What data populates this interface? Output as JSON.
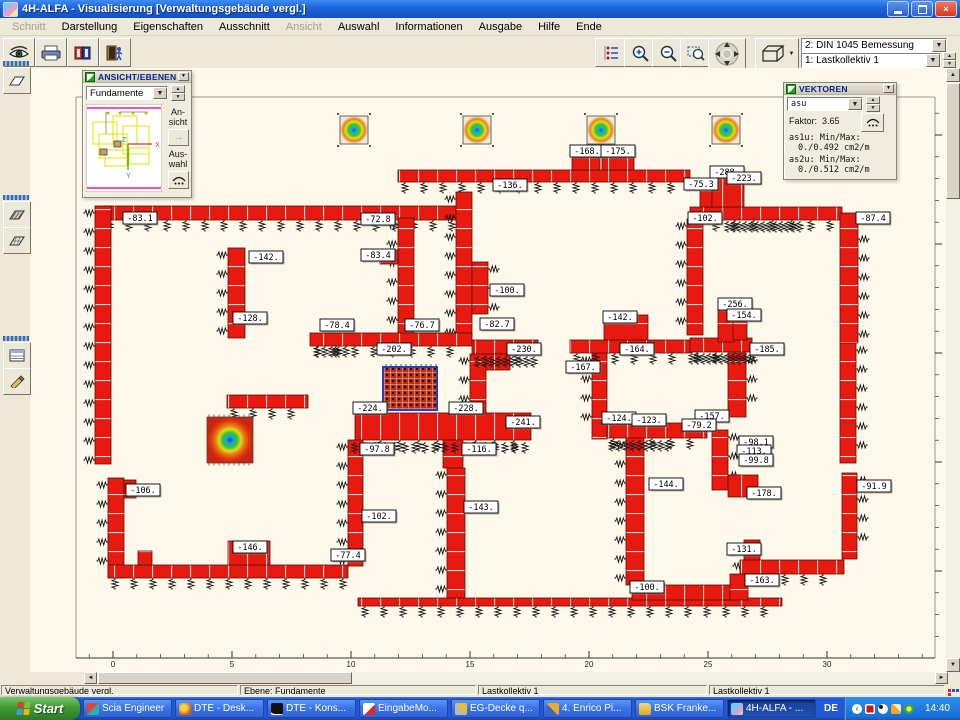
{
  "window": {
    "title": "4H-ALFA - Visualisierung [Verwaltungsgebäude vergl.]"
  },
  "menu": {
    "items": [
      {
        "label": "Schnitt",
        "enabled": false
      },
      {
        "label": "Darstellung",
        "enabled": true
      },
      {
        "label": "Eigenschaften",
        "enabled": true
      },
      {
        "label": "Ausschnitt",
        "enabled": true
      },
      {
        "label": "Ansicht",
        "enabled": false
      },
      {
        "label": "Auswahl",
        "enabled": true
      },
      {
        "label": "Informationen",
        "enabled": true
      },
      {
        "label": "Ausgabe",
        "enabled": true
      },
      {
        "label": "Hilfe",
        "enabled": true
      },
      {
        "label": "Ende",
        "enabled": true
      }
    ]
  },
  "toolbar": {
    "left_icons": [
      "view-eye",
      "print",
      "manual-book",
      "exit-door"
    ],
    "right_icons": [
      "number-options",
      "zoom-in",
      "zoom-out",
      "zoom-window",
      "pan",
      "view-3d"
    ],
    "combo_design": "2: DIN 1045 Bemessung",
    "combo_load": "1: Lastkollektiv 1"
  },
  "ansicht_panel": {
    "title": "ANSICHT/EBENEN",
    "combo": "Fundamente",
    "ansicht_label_1": "An-",
    "ansicht_label_2": "sicht",
    "auswahl_label_1": "Aus-",
    "auswahl_label_2": "wahl",
    "axis": {
      "x": "X",
      "y": "Y",
      "z": "Z"
    }
  },
  "vektoren_panel": {
    "title": "VEKTOREN",
    "combo": "asu",
    "faktor_label": "Faktor:",
    "faktor_value": "3.65",
    "as1u_label": "as1u: Min/Max:",
    "as1u_value": "0./0.492 cm2/m",
    "as2u_label": "as2u: Min/Max:",
    "as2u_value": "0./0.512 cm2/m"
  },
  "statusbar": {
    "fields": [
      "Verwaltungsgebäude vergl.",
      "Ebene: Fundamente",
      "Lastkollektiv 1",
      "Lastkollektiv 1"
    ]
  },
  "taskbar": {
    "start": "Start",
    "tasks": [
      {
        "label": "Scia Engineer",
        "active": false
      },
      {
        "label": "DTE - Desk...",
        "active": false
      },
      {
        "label": "DTE - Kons...",
        "active": false
      },
      {
        "label": "EingabeMo...",
        "active": false
      },
      {
        "label": "EG-Decke q...",
        "active": false
      },
      {
        "label": "4. Enrico Pi...",
        "active": false
      },
      {
        "label": "BSK Franke...",
        "active": false
      },
      {
        "label": "4H-ALFA - ...",
        "active": true
      }
    ],
    "lang": "DE",
    "clock": "14:40"
  },
  "plan": {
    "colors": {
      "wall": "#E8190E",
      "canvas": "#FCF8EA"
    },
    "frame": [
      [
        76,
        97,
        935,
        97
      ],
      [
        76,
        97,
        76,
        658
      ],
      [
        935,
        97,
        935,
        658
      ],
      [
        76,
        658,
        935,
        658
      ]
    ],
    "walls": [
      [
        103,
        206,
        354,
        14,
        "h",
        "b"
      ],
      [
        398,
        170,
        292,
        12,
        "h",
        "b"
      ],
      [
        572,
        152,
        28,
        18,
        "h",
        ""
      ],
      [
        602,
        149,
        32,
        21,
        "h",
        ""
      ],
      [
        690,
        207,
        152,
        13,
        "h",
        "b"
      ],
      [
        700,
        188,
        12,
        19,
        "v",
        ""
      ],
      [
        712,
        176,
        32,
        31,
        "h",
        ""
      ],
      [
        95,
        206,
        16,
        258,
        "v",
        "l"
      ],
      [
        108,
        478,
        16,
        100,
        "v",
        "l"
      ],
      [
        124,
        480,
        12,
        18,
        "v",
        ""
      ],
      [
        228,
        248,
        17,
        90,
        "v",
        "l"
      ],
      [
        398,
        218,
        16,
        120,
        "v",
        "l"
      ],
      [
        380,
        250,
        18,
        14,
        "h",
        ""
      ],
      [
        456,
        192,
        16,
        144,
        "v",
        "l"
      ],
      [
        472,
        262,
        16,
        52,
        "v",
        "r"
      ],
      [
        310,
        333,
        162,
        13,
        "h",
        "b"
      ],
      [
        472,
        340,
        66,
        14,
        "h",
        "b"
      ],
      [
        480,
        354,
        30,
        16,
        "h",
        ""
      ],
      [
        227,
        395,
        81,
        13,
        "h",
        "b"
      ],
      [
        355,
        413,
        176,
        27,
        "h",
        "b"
      ],
      [
        470,
        354,
        16,
        59,
        "v",
        "l"
      ],
      [
        443,
        440,
        20,
        28,
        "v",
        ""
      ],
      [
        447,
        468,
        18,
        134,
        "v",
        "l"
      ],
      [
        348,
        440,
        15,
        126,
        "v",
        "l"
      ],
      [
        108,
        565,
        240,
        13,
        "h",
        "b"
      ],
      [
        138,
        551,
        14,
        14,
        "v",
        ""
      ],
      [
        228,
        541,
        42,
        24,
        "h",
        ""
      ],
      [
        358,
        598,
        424,
        8,
        "h",
        "b"
      ],
      [
        632,
        585,
        106,
        15,
        "h",
        ""
      ],
      [
        592,
        353,
        15,
        86,
        "v",
        "l"
      ],
      [
        570,
        340,
        122,
        13,
        "h",
        "b"
      ],
      [
        604,
        315,
        44,
        25,
        "v",
        ""
      ],
      [
        690,
        338,
        62,
        14,
        "h",
        "b"
      ],
      [
        728,
        353,
        18,
        64,
        "v",
        "r"
      ],
      [
        607,
        423,
        100,
        15,
        "h",
        "b"
      ],
      [
        687,
        219,
        16,
        116,
        "v",
        "l"
      ],
      [
        840,
        213,
        18,
        130,
        "v",
        "r"
      ],
      [
        840,
        343,
        16,
        120,
        "v",
        "r"
      ],
      [
        842,
        473,
        15,
        86,
        "v",
        "r"
      ],
      [
        712,
        430,
        16,
        60,
        "v",
        "r"
      ],
      [
        728,
        475,
        30,
        22,
        "h",
        ""
      ],
      [
        744,
        540,
        16,
        46,
        "v",
        "l"
      ],
      [
        740,
        560,
        104,
        14,
        "h",
        "b"
      ],
      [
        730,
        574,
        18,
        26,
        "v",
        ""
      ],
      [
        626,
        438,
        18,
        147,
        "v",
        "l"
      ],
      [
        718,
        308,
        16,
        34,
        "v",
        ""
      ],
      [
        733,
        320,
        14,
        20,
        "v",
        ""
      ]
    ],
    "spring_rows": [
      [
        318,
        350,
        346,
        7
      ],
      [
        478,
        540,
        356,
        7
      ],
      [
        692,
        752,
        353,
        6
      ],
      [
        612,
        668,
        440,
        7
      ],
      [
        728,
        800,
        221,
        6
      ],
      [
        355,
        528,
        442,
        10
      ]
    ],
    "mesh": [
      383,
      367,
      54,
      43
    ],
    "footings": [
      [
        "gA",
        340,
        116,
        28
      ],
      [
        "gA",
        463,
        116,
        28
      ],
      [
        "gA",
        587,
        116,
        28
      ],
      [
        "gA",
        712,
        116,
        28
      ],
      [
        "gB",
        207,
        417,
        46
      ]
    ],
    "labels": [
      [
        "-83.1",
        140,
        218
      ],
      [
        "-72.8",
        378,
        219
      ],
      [
        "-136.",
        510,
        185
      ],
      [
        "-168.",
        587,
        151
      ],
      [
        "-175.",
        618,
        151
      ],
      [
        "-288.",
        727,
        172
      ],
      [
        "-223.",
        744,
        178
      ],
      [
        "-75.3",
        701,
        184
      ],
      [
        "-102.",
        705,
        218
      ],
      [
        "-87.4",
        873,
        218
      ],
      [
        "-142.",
        266,
        257
      ],
      [
        "-83.4",
        378,
        255
      ],
      [
        "-100.",
        507,
        290
      ],
      [
        "-128.",
        250,
        318
      ],
      [
        "-256.",
        735,
        304
      ],
      [
        "-154.",
        744,
        315
      ],
      [
        "-142.",
        620,
        317
      ],
      [
        "-78.4",
        337,
        325
      ],
      [
        "-76.7",
        422,
        325
      ],
      [
        "-82.7",
        497,
        324
      ],
      [
        "-202.",
        394,
        349
      ],
      [
        "-230.",
        524,
        349
      ],
      [
        "-164.",
        637,
        349
      ],
      [
        "-167.",
        583,
        367
      ],
      [
        "-185.",
        767,
        349
      ],
      [
        "-224.",
        370,
        408
      ],
      [
        "-228.",
        466,
        408
      ],
      [
        "-241.",
        523,
        422
      ],
      [
        "-124.",
        619,
        418
      ],
      [
        "-123.",
        649,
        420
      ],
      [
        "-157.",
        712,
        416
      ],
      [
        "-79.2",
        699,
        425
      ],
      [
        "-98.1",
        756,
        442
      ],
      [
        "-113.",
        754,
        451
      ],
      [
        "-99.8",
        756,
        460
      ],
      [
        "-97.8",
        377,
        449
      ],
      [
        "-116.",
        479,
        449
      ],
      [
        "-144.",
        666,
        484
      ],
      [
        "-178.",
        764,
        493
      ],
      [
        "-91.9",
        874,
        486
      ],
      [
        "-106.",
        143,
        490
      ],
      [
        "-102.",
        379,
        516
      ],
      [
        "-143.",
        481,
        507
      ],
      [
        "-146.",
        250,
        547
      ],
      [
        "-77.4",
        348,
        555
      ],
      [
        "-131.",
        744,
        549
      ],
      [
        "-100.",
        647,
        587
      ],
      [
        "-163.",
        762,
        580
      ]
    ],
    "hruler": {
      "y": 658,
      "x_start": 76,
      "x_end": 935,
      "origin_x": 113,
      "unit_px": 23.8,
      "label_every": 5,
      "max_label": 30
    },
    "vruler": {
      "x": 935,
      "y_start": 97,
      "y_end": 658,
      "origin_y": 135,
      "unit_px": 21.8,
      "label_every": 5,
      "max_label": 20
    }
  }
}
